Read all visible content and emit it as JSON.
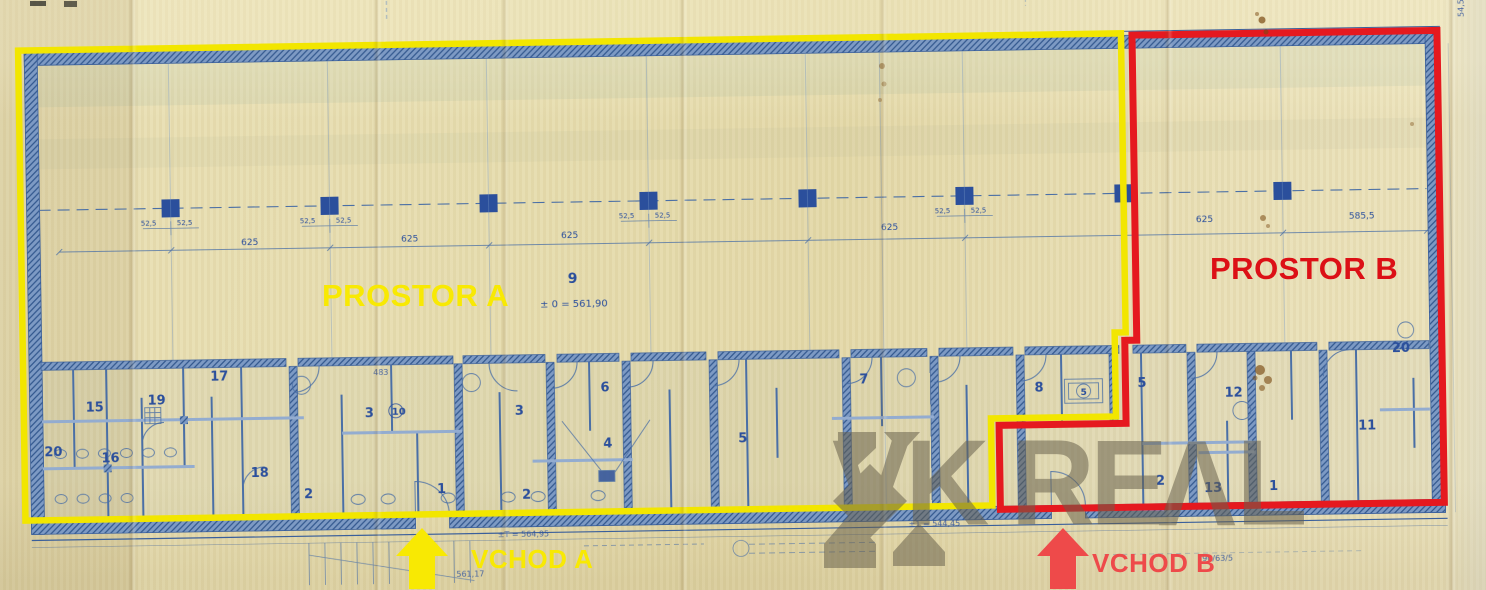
{
  "annotations": {
    "region_a": {
      "label": "PROSTOR A",
      "color": "#f8e903"
    },
    "region_b": {
      "label": "PROSTOR B",
      "color": "#dc1016"
    },
    "entrance_a": {
      "label": "VCHOD A",
      "color": "#f8e903"
    },
    "entrance_b": {
      "label": "VCHOD B",
      "color": "#ee4a4a"
    }
  },
  "watermark": {
    "brand": "VK REAL",
    "part_vk": "VK",
    "part_re": "RE",
    "part_a": "V",
    "part_l": "L",
    "color": "#68604d"
  },
  "plan": {
    "station_label": "9",
    "level_note": "± 0 = 561,90",
    "rooms": [
      {
        "n": "15"
      },
      {
        "n": "19"
      },
      {
        "n": "17"
      },
      {
        "n": "20"
      },
      {
        "n": "16"
      },
      {
        "n": "18"
      },
      {
        "n": "2"
      },
      {
        "n": "3"
      },
      {
        "n": "10"
      },
      {
        "n": "1"
      },
      {
        "n": "2"
      },
      {
        "n": "3"
      },
      {
        "n": "6"
      },
      {
        "n": "4"
      },
      {
        "n": "5"
      },
      {
        "n": "7"
      },
      {
        "n": "8"
      },
      {
        "n": "5"
      },
      {
        "n": "2"
      },
      {
        "n": "12"
      },
      {
        "n": "13"
      },
      {
        "n": "1"
      },
      {
        "n": "11"
      },
      {
        "n": "20"
      },
      {
        "n": "5"
      }
    ],
    "dims": [
      {
        "t": "625"
      },
      {
        "t": "625"
      },
      {
        "t": "625"
      },
      {
        "t": "625"
      },
      {
        "t": "625"
      },
      {
        "t": "585,5"
      }
    ],
    "col_dim": "52,5",
    "misc": [
      {
        "t": "±T = 564,95"
      },
      {
        "t": "561,17"
      },
      {
        "t": "±1 = 544,45"
      },
      {
        "t": "483"
      },
      {
        "t": "54,5"
      },
      {
        "t": "10"
      },
      {
        "t": "90/63/5"
      }
    ]
  }
}
